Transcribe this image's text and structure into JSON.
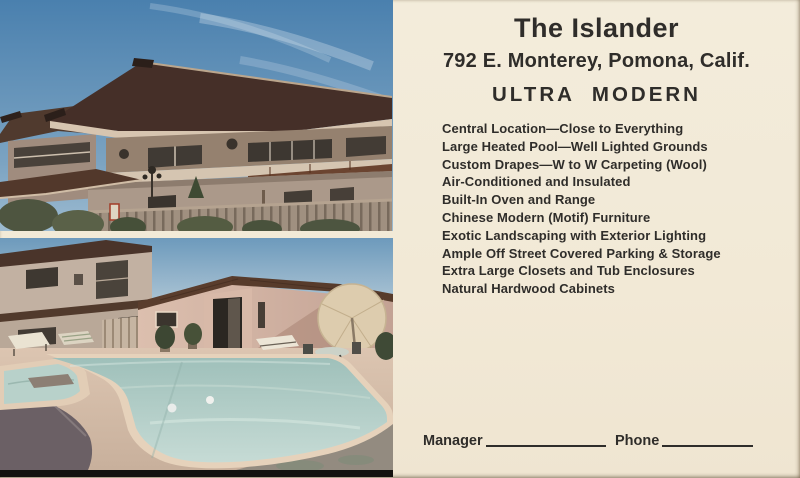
{
  "card_type": "vintage advertising postcard",
  "header": {
    "title": "The Islander",
    "address": "792 E. Monterey, Pomona, Calif.",
    "tagline": "ULTRA MODERN"
  },
  "features": {
    "items": [
      "Central Location—Close to Everything",
      "Large Heated Pool—Well Lighted Grounds",
      "Custom Drapes—W to W Carpeting (Wool)",
      "Air-Conditioned and Insulated",
      "Built-In Oven and Range",
      "Chinese Modern (Motif) Furniture",
      "Exotic Landscaping with Exterior Lighting",
      "Ample Off Street Covered Parking & Storage",
      "Extra Large Closets and Tub Enclosures",
      "Natural Hardwood Cabinets"
    ]
  },
  "footer": {
    "manager_label": "Manager",
    "phone_label": "Phone"
  },
  "photos": {
    "top_label": "apartment-building-exterior",
    "bottom_label": "swimming-pool-and-grounds"
  },
  "palette": {
    "card_background": "#f2ebda",
    "ink": "#2f2d2a",
    "sky_blue": "#4a80ae",
    "roof_brown": "#452f28",
    "wall_tan": "#c2b1a2",
    "pool_water": "#a3c2bc",
    "deck_tan": "#d8c2ae",
    "photo_bottom_strip": "#141210"
  }
}
